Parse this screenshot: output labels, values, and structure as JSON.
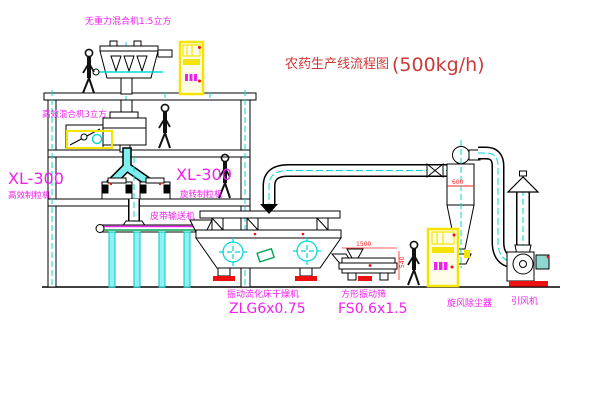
{
  "title": {
    "cn": "农药生产线流程图",
    "capacity": "(500kg/h)"
  },
  "labels": {
    "top_mixer": "无重力混合机1.5立方",
    "floor2_mixer": "高效混合机3立方",
    "left_granulator_model": "XL-300",
    "left_granulator_name": "高效制粒机",
    "mid_granulator_model": "XL-300",
    "mid_granulator_name": "旋转制粒机",
    "belt_conveyor": "皮带输送机",
    "dryer_name": "振动流化床干燥机",
    "dryer_model": "ZLG6x0.75",
    "screen_name": "方形振动筛",
    "screen_model": "FS0.6x1.5",
    "cyclone": "旋风除尘器",
    "fan": "引风机"
  },
  "dimensions": {
    "cyclone_dia": "600",
    "screen_length": "1500",
    "screen_height": "540"
  },
  "colors": {
    "line": "#000000",
    "centerline_cyan": "#00d8d8",
    "label_magenta": "#ee22ee",
    "title_red": "#cc3a3a",
    "dim_red": "#ff2020",
    "cabinet_yellow": "#f5e400",
    "pad_red": "#ee1010",
    "belt_green": "#00a550",
    "background": "#ffffff"
  }
}
